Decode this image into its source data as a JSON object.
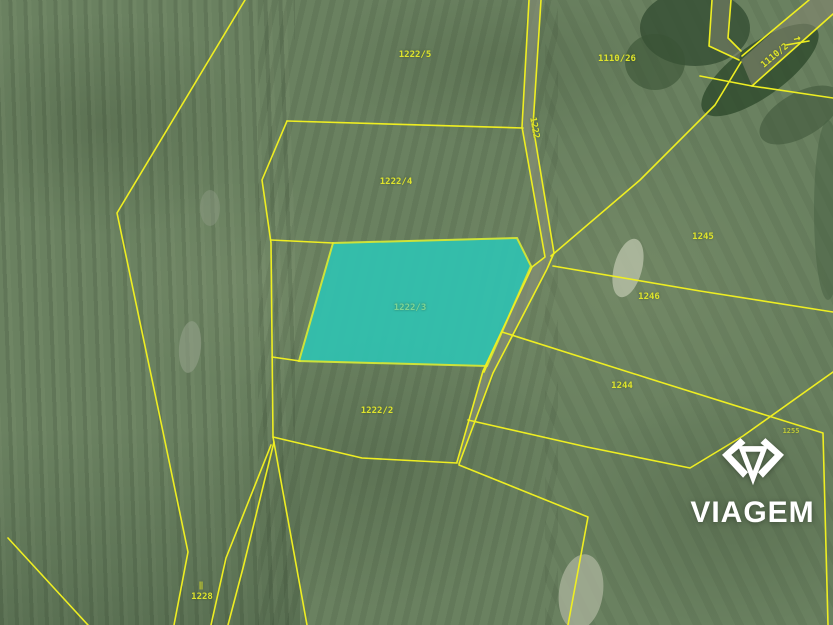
{
  "logo": {
    "text": "VIAGEM",
    "color": "#ffffff"
  },
  "map": {
    "background": "#6a8160",
    "line_color": "#eeee22",
    "label_color": "#dfe42c",
    "highlight": {
      "label": "1222/3",
      "fill": "#2fc3b2",
      "fill_opacity": 0.9,
      "stroke": "#cde23a",
      "polygon": [
        [
          333,
          243
        ],
        [
          517,
          238
        ],
        [
          531,
          266
        ],
        [
          487,
          366
        ],
        [
          299,
          361
        ]
      ]
    },
    "parcel_labels": [
      {
        "text": "1222/5",
        "x": 415,
        "y": 55,
        "rot": 0
      },
      {
        "text": "1110/26",
        "x": 617,
        "y": 59,
        "rot": 0
      },
      {
        "text": "1222/4",
        "x": 396,
        "y": 182,
        "rot": 0
      },
      {
        "text": "1222",
        "x": 534,
        "y": 128,
        "rot": 80
      },
      {
        "text": "1222/3",
        "x": 410,
        "y": 308,
        "rot": 0,
        "color": "#7fd694"
      },
      {
        "text": "1245",
        "x": 703,
        "y": 237,
        "rot": 0
      },
      {
        "text": "1246",
        "x": 649,
        "y": 297,
        "rot": 0
      },
      {
        "text": "1244",
        "x": 622,
        "y": 386,
        "rot": 0
      },
      {
        "text": "1222/2",
        "x": 377,
        "y": 411,
        "rot": 0
      },
      {
        "text": "1228",
        "x": 202,
        "y": 597,
        "rot": 0
      },
      {
        "text": "1110/2",
        "x": 775,
        "y": 56,
        "rot": -40
      },
      {
        "text": "1255",
        "x": 791,
        "y": 431,
        "rot": 0,
        "size": 7,
        "opacity": 0.75
      },
      {
        "text": "‖",
        "x": 201,
        "y": 585,
        "rot": 0,
        "size": 8,
        "name": "boundary-marker-icon"
      },
      {
        "text": "→",
        "x": 797,
        "y": 38,
        "rot": -12,
        "size": 12,
        "name": "direction-arrow-icon"
      }
    ],
    "boundary_lines": [
      {
        "name": "left-long-boundary",
        "points": [
          [
            245,
            0
          ],
          [
            117,
            213
          ],
          [
            158,
            408
          ],
          [
            188,
            552
          ],
          [
            174,
            625
          ]
        ]
      },
      {
        "name": "corner-strip-line",
        "points": [
          [
            8,
            538
          ],
          [
            88,
            625
          ]
        ]
      },
      {
        "name": "strip-line-2",
        "points": [
          [
            271,
            445
          ],
          [
            226,
            558
          ],
          [
            211,
            625
          ]
        ]
      },
      {
        "name": "strip-line-3",
        "points": [
          [
            274,
            442
          ],
          [
            243,
            568
          ],
          [
            228,
            625
          ]
        ]
      },
      {
        "name": "field-left-boundary",
        "points": [
          [
            287,
            121
          ],
          [
            262,
            180
          ],
          [
            271,
            243
          ],
          [
            273,
            437
          ],
          [
            307,
            625
          ]
        ]
      },
      {
        "name": "divider-1222-5-4",
        "points": [
          [
            287,
            121
          ],
          [
            523,
            128
          ]
        ]
      },
      {
        "name": "divider-1222-4-3",
        "points": [
          [
            271,
            240
          ],
          [
            333,
            243
          ]
        ]
      },
      {
        "name": "divider-1222-3-2",
        "points": [
          [
            272,
            357
          ],
          [
            300,
            361
          ]
        ]
      },
      {
        "name": "divider-right-stub",
        "points": [
          [
            487,
            365
          ],
          [
            484,
            372
          ]
        ]
      },
      {
        "name": "bottom-1222-2-boundary",
        "points": [
          [
            273,
            437
          ],
          [
            362,
            458
          ],
          [
            457,
            463
          ]
        ]
      },
      {
        "name": "road-left-line",
        "points": [
          [
            529,
            0
          ],
          [
            522,
            127
          ],
          [
            545,
            257
          ],
          [
            532,
            267
          ],
          [
            483,
            371
          ],
          [
            457,
            462
          ]
        ]
      },
      {
        "name": "road-right-line",
        "points": [
          [
            541,
            0
          ],
          [
            533,
            126
          ],
          [
            554,
            253
          ],
          [
            547,
            269
          ],
          [
            493,
            373
          ],
          [
            459,
            464
          ]
        ]
      },
      {
        "name": "fan-northeast",
        "points": [
          [
            551,
            256
          ],
          [
            640,
            180
          ],
          [
            715,
            105
          ],
          [
            741,
            62
          ]
        ]
      },
      {
        "name": "fan-east-1",
        "points": [
          [
            553,
            266
          ],
          [
            700,
            291
          ],
          [
            833,
            312
          ]
        ]
      },
      {
        "name": "fan-east-2",
        "points": [
          [
            502,
            332
          ],
          [
            660,
            382
          ],
          [
            823,
            433
          ],
          [
            828,
            625
          ]
        ]
      },
      {
        "name": "diagonal-southeast",
        "points": [
          [
            468,
            420
          ],
          [
            587,
            447
          ],
          [
            690,
            468
          ],
          [
            743,
            436
          ],
          [
            833,
            372
          ]
        ]
      },
      {
        "name": "corner-southeast",
        "points": [
          [
            459,
            465
          ],
          [
            588,
            517
          ],
          [
            568,
            625
          ]
        ]
      },
      {
        "name": "narrow-road-left",
        "points": [
          [
            712,
            0
          ],
          [
            709,
            46
          ],
          [
            739,
            60
          ]
        ]
      },
      {
        "name": "narrow-road-right",
        "points": [
          [
            731,
            0
          ],
          [
            728,
            38
          ],
          [
            741,
            51
          ]
        ]
      },
      {
        "name": "big-road-upper",
        "points": [
          [
            809,
            0
          ],
          [
            742,
            56
          ]
        ]
      },
      {
        "name": "big-road-lower-a",
        "points": [
          [
            833,
            14
          ],
          [
            779,
            62
          ],
          [
            752,
            86
          ]
        ]
      },
      {
        "name": "big-road-lower-b",
        "points": [
          [
            752,
            86
          ],
          [
            833,
            98
          ]
        ]
      },
      {
        "name": "big-road-spur",
        "points": [
          [
            752,
            86
          ],
          [
            700,
            76
          ]
        ]
      },
      {
        "name": "arrow-underline",
        "points": [
          [
            786,
            45
          ],
          [
            809,
            41
          ]
        ]
      }
    ],
    "road_fills": [
      {
        "name": "road-ns-fill",
        "points": [
          [
            529,
            0
          ],
          [
            541,
            0
          ],
          [
            533,
            126
          ],
          [
            554,
            253
          ],
          [
            547,
            269
          ],
          [
            493,
            373
          ],
          [
            459,
            464
          ],
          [
            457,
            462
          ],
          [
            483,
            371
          ],
          [
            532,
            267
          ],
          [
            545,
            257
          ],
          [
            522,
            127
          ]
        ],
        "color": "#8d927c",
        "opacity": 0.55
      },
      {
        "name": "road-ne-fill",
        "points": [
          [
            809,
            0
          ],
          [
            833,
            0
          ],
          [
            833,
            14
          ],
          [
            779,
            62
          ],
          [
            752,
            86
          ],
          [
            741,
            60
          ]
        ],
        "color": "#83876f",
        "opacity": 0.6
      },
      {
        "name": "road-narrow-fill",
        "points": [
          [
            712,
            0
          ],
          [
            731,
            0
          ],
          [
            728,
            38
          ],
          [
            741,
            51
          ],
          [
            739,
            60
          ],
          [
            709,
            46
          ]
        ],
        "color": "#83876f",
        "opacity": 0.5
      }
    ],
    "patches": [
      {
        "name": "trees-top-right-1",
        "cx": 695,
        "cy": 28,
        "rx": 55,
        "ry": 38,
        "rot": 0,
        "color": "#324b30",
        "opacity": 0.75
      },
      {
        "name": "trees-top-right-2",
        "cx": 655,
        "cy": 62,
        "rx": 30,
        "ry": 28,
        "rot": 0,
        "color": "#3a5336",
        "opacity": 0.6
      },
      {
        "name": "trees-along-road",
        "cx": 760,
        "cy": 70,
        "rx": 70,
        "ry": 26,
        "rot": -36,
        "color": "#2e4a2c",
        "opacity": 0.8
      },
      {
        "name": "trees-south-road",
        "cx": 800,
        "cy": 115,
        "rx": 45,
        "ry": 22,
        "rot": -30,
        "color": "#41583c",
        "opacity": 0.6
      },
      {
        "name": "trees-right-edge",
        "cx": 828,
        "cy": 210,
        "rx": 14,
        "ry": 90,
        "rot": 0,
        "color": "#465f41",
        "opacity": 0.5
      },
      {
        "name": "bare-patch-1246",
        "cx": 628,
        "cy": 268,
        "rx": 14,
        "ry": 30,
        "rot": 15,
        "color": "#b8c0a8",
        "opacity": 0.8
      },
      {
        "name": "bare-patch-bottom",
        "cx": 581,
        "cy": 592,
        "rx": 22,
        "ry": 38,
        "rot": 8,
        "color": "#a8b098",
        "opacity": 0.8
      },
      {
        "name": "bare-patch-left",
        "cx": 190,
        "cy": 347,
        "rx": 11,
        "ry": 26,
        "rot": 5,
        "color": "#93a088",
        "opacity": 0.6
      },
      {
        "name": "bare-patch-left-2",
        "cx": 210,
        "cy": 208,
        "rx": 10,
        "ry": 18,
        "rot": 0,
        "color": "#8f9c84",
        "opacity": 0.45
      }
    ]
  }
}
